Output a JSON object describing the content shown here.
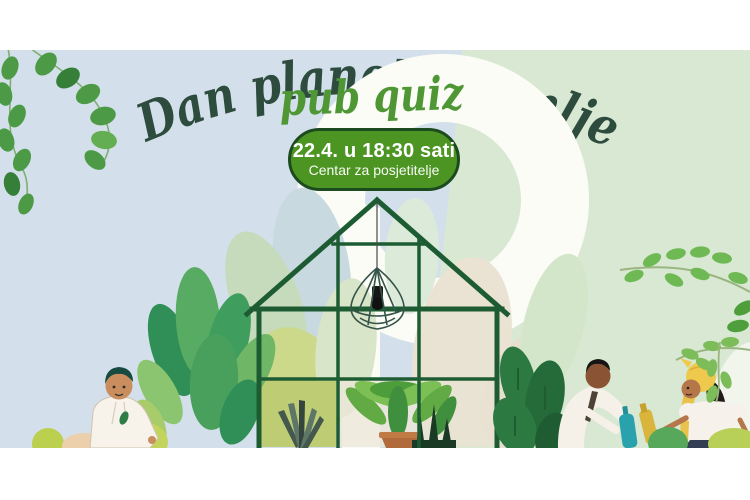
{
  "poster": {
    "title": "Dan planeta Zemlje",
    "subtitle": "pub quiz",
    "badge": {
      "line1": "22.4. u 18:30 sati",
      "line2": "Centar za posjetitelje"
    }
  },
  "colors": {
    "bg-left": "#d3e0eb",
    "bg-right": "#d9e8d3",
    "swoosh": "#fbfcf6",
    "title-color": "#2d4c3e",
    "subtitle-color": "#4f9635",
    "badge-fill": "#4d9523",
    "badge-border": "#1d4b20",
    "badge-text": "#ffffff",
    "frame": "#1d5c33",
    "vine-green": "#4d9a46",
    "terracotta": "#b06a3c",
    "olive-pane": "#becd74"
  },
  "illustration": {
    "scene": "greenhouse with pendant lamp, potted plants and three gardeners",
    "elements": [
      "hanging-vine",
      "white-swoosh",
      "greenhouse",
      "pendant-lamp",
      "snake-plant",
      "fern-pot",
      "monstera",
      "left-gardener",
      "right-gardener",
      "woman-gardener",
      "leaf-branches"
    ]
  }
}
